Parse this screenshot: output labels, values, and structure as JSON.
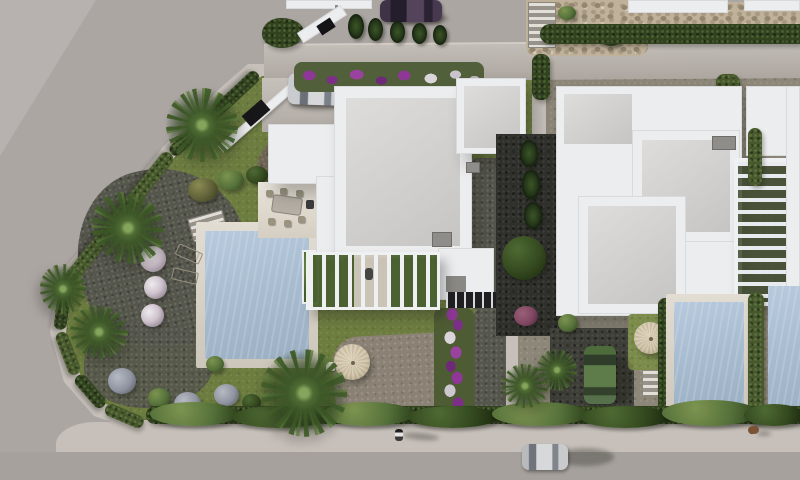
{
  "scene": {
    "type": "aerial-3d-architectural-render",
    "description": "Top-down 3D architect's render of a modern Mediterranean corner-plot villa development: white flat-roofed villas with private pools, lawns, palm trees, purple bougainvillea beds, cypress hedges, parked cars and a street wrapping the left and bottom edges.",
    "buildings": [
      "main corner villa with pergola and roof terrace levels",
      "neighbouring villa (right) with slatted pergola",
      "partial far-right villa",
      "upper neighbour parcels with retaining wall and rockery"
    ],
    "pools": [
      "main villa pool (left garden)",
      "right villa pool",
      "far-right villa pool (partial)"
    ],
    "vehicles": [
      "silver hatchback parked on main driveway",
      "dark purple car parked on upper street",
      "green SUV on right-hand driveway",
      "silver car driving on bottom road"
    ],
    "figures": [
      "pedestrian walking on bottom sidewalk",
      "small dog on sidewalk (right)"
    ],
    "garden_features": [
      "two sun loungers by pool",
      "outdoor dining table with chairs on terrace",
      "two beige parasols",
      "stone steps",
      "round lavender and flowering shrubs",
      "palm trees",
      "gravel and lawn areas",
      "magenta flower beds"
    ]
  },
  "palette": {
    "road": "#aca6a3",
    "roadLight": "#bab4b1",
    "asphaltBottom": "#a6a19d",
    "sidewalk": "#c7c0ba",
    "grass": "#6d7d40",
    "grassLight": "#7b8b4a",
    "hedgeDark": "#31421f",
    "hedgeMid": "#46582c",
    "hedgeLight": "#5f7436",
    "whiteRoof": "#ecedef",
    "grayRoof": "#d2d1cf",
    "grayRoofDark": "#8f8d89",
    "terrace": "#ded7ca",
    "poolDeck": "#d8d1c4",
    "poolWater": "#a9bdd1",
    "concrete": "#b6afa8",
    "gravelWarm": "#8d8779",
    "gravelDark": "#55564c",
    "gravelBlack": "#2f2f2b",
    "soil": "#6f6555",
    "path": "#8b8275",
    "rock": "#c0b29a",
    "flowerMagenta": "#8e3796",
    "carSilver": "#d7d8da",
    "carPurple": "#53445c",
    "carGreen": "#5e7c49",
    "parasol": "#d3c6ab"
  }
}
